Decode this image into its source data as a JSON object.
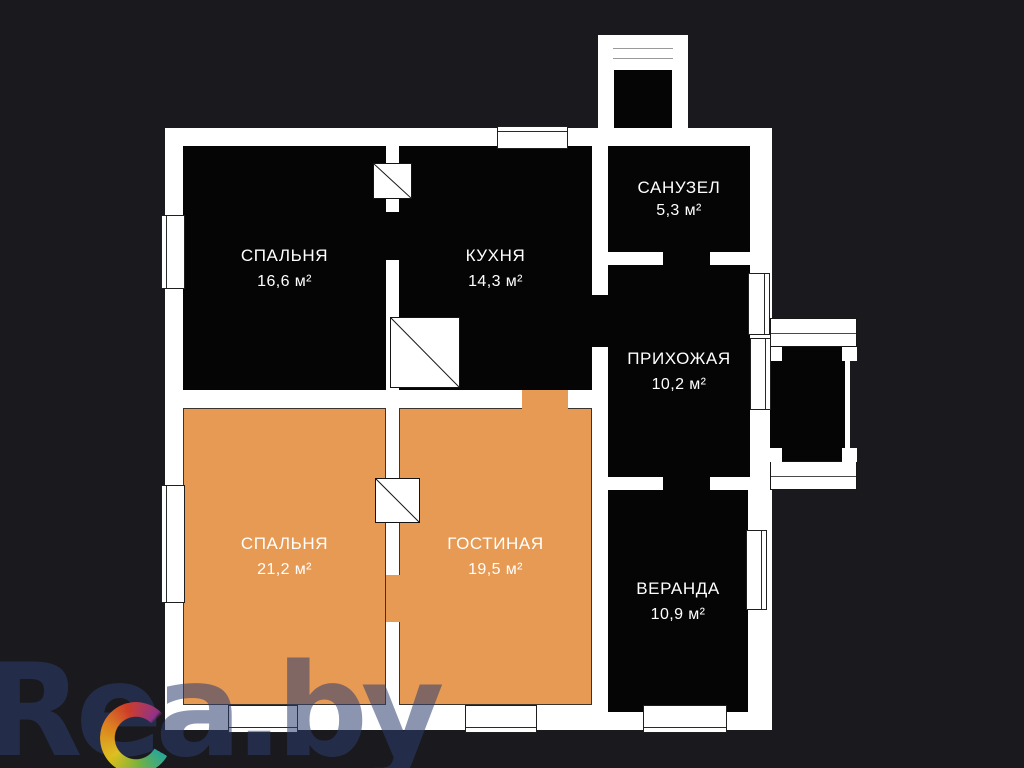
{
  "page": {
    "type": "apartment-floor-plan"
  },
  "colors": {
    "background": "#1a1a1e",
    "walls": "#ffffff",
    "room_fill_dark": "#050505",
    "room_fill_orange": "#e69a54",
    "label_text": "#ffffff",
    "watermark_text_color": "#2c3e70"
  },
  "rooms": [
    {
      "name": "СПАЛЬНЯ",
      "area": "16,6 м²"
    },
    {
      "name": "КУХНЯ",
      "area": "14,3 м²"
    },
    {
      "name": "САНУЗЕЛ",
      "area": "5,3 м²"
    },
    {
      "name": "ПРИХОЖАЯ",
      "area": "10,2 м²"
    },
    {
      "name": "СПАЛЬНЯ",
      "area": "21,2 м²"
    },
    {
      "name": "ГОСТИНАЯ",
      "area": "19,5 м²"
    },
    {
      "name": "ВЕРАНДА",
      "area": "10,9 м²"
    }
  ],
  "watermark": {
    "text": "Rea.by"
  }
}
